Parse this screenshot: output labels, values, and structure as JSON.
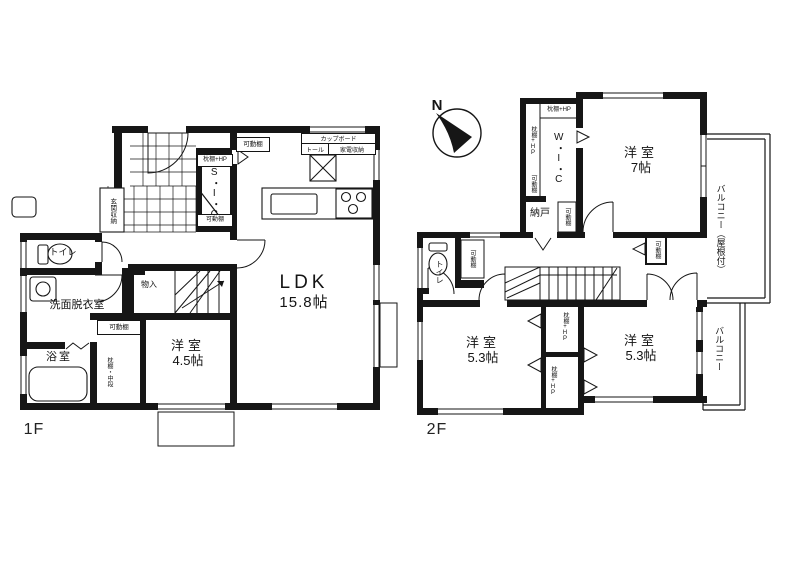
{
  "floor_plan": {
    "floor1": {
      "label": "1F",
      "rooms": {
        "ldk": {
          "name": "LDK",
          "size": "15.8帖"
        },
        "bedroom": {
          "name": "洋室",
          "size": "4.5帖"
        },
        "bath": {
          "name": "浴室"
        },
        "washroom": {
          "name": "洗面脱衣室"
        },
        "toilet": {
          "name": "トイレ"
        },
        "storage": {
          "name": "物入"
        },
        "sic": {
          "name": "S・I・C"
        },
        "entrance_storage": {
          "name": "玄関収納"
        }
      },
      "kitchen": {
        "cupboard": "カップボード",
        "tall": "トール",
        "appliance": "家電収納"
      },
      "shelves": {
        "movable": "可動棚",
        "pillow_hp": "枕棚+HP",
        "pillow_mid": "枕棚・中段"
      }
    },
    "floor2": {
      "label": "2F",
      "compass": "N",
      "rooms": {
        "bedroom7": {
          "name": "洋室",
          "size": "7帖"
        },
        "bedroom53a": {
          "name": "洋室",
          "size": "5.3帖"
        },
        "bedroom53b": {
          "name": "洋室",
          "size": "5.3帖"
        },
        "wic": {
          "name": "W・I・C"
        },
        "nando": {
          "name": "納戸"
        },
        "toilet": {
          "name": "トイレ"
        },
        "balcony_roofed": {
          "name": "バルコニー（屋根付）"
        },
        "balcony": {
          "name": "バルコニー"
        }
      },
      "shelves": {
        "movable": "可動棚",
        "pillow_hp": "枕棚+HP"
      }
    }
  }
}
